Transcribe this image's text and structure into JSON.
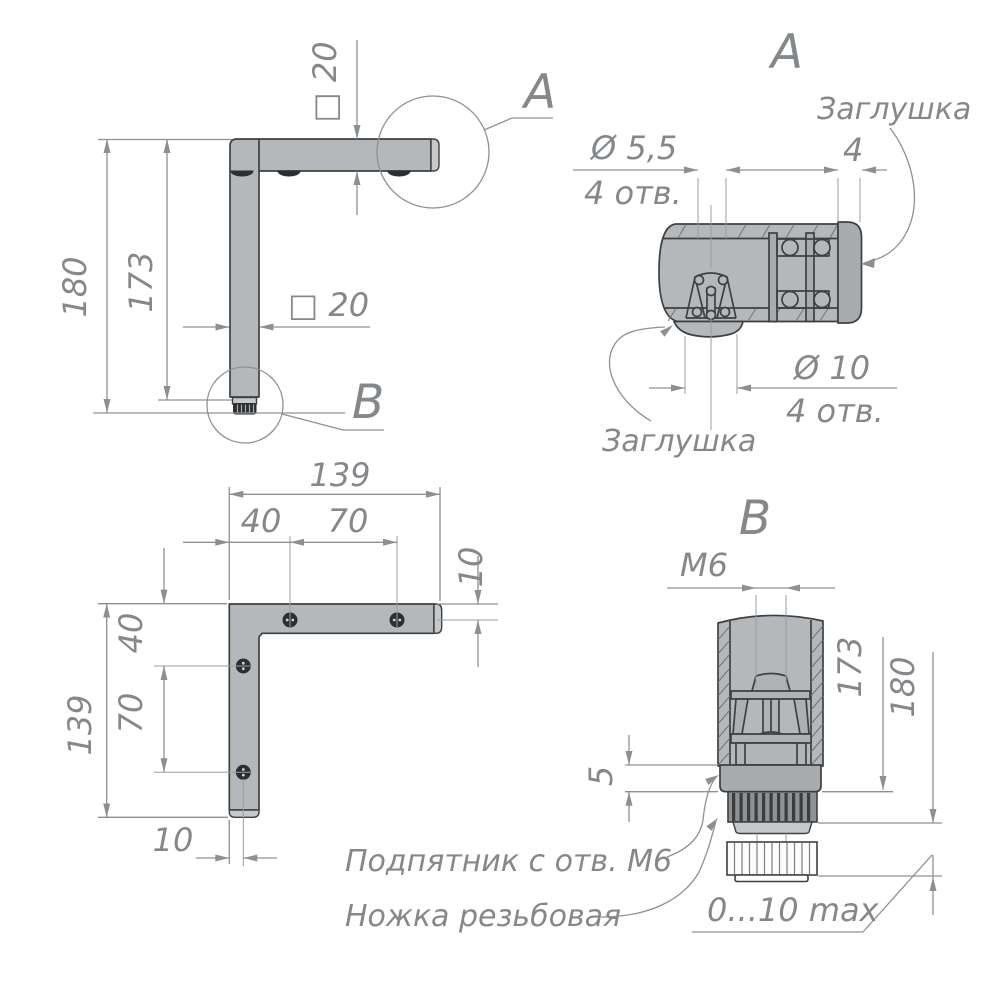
{
  "colors": {
    "paper": "#ffffff",
    "metal_fill": "#b5b8ba",
    "outline": "#3d4043",
    "dimension_gray": "#8d9093",
    "hole_black": "#2c2e30"
  },
  "main_view": {
    "dim_height_total": "180",
    "dim_height_leg": "173",
    "dim_arm_section": "□ 20",
    "dim_leg_section": "□ 20",
    "callout_a": "A",
    "callout_b": "B"
  },
  "detail_a": {
    "title": "A",
    "label_plug_top": "Заглушка",
    "label_plug_bottom": "Заглушка",
    "dim_hole_dia": "Ø 5,5",
    "dim_hole_qty": "4 отв.",
    "dim_cap": "4",
    "dim_plug_dia": "Ø 10",
    "dim_plug_qty": "4 отв."
  },
  "plan_view": {
    "dim_width": "139",
    "dim_hole_a": "40",
    "dim_hole_b": "70",
    "dim_edge_right": "10",
    "dim_height": "139",
    "dim_hole_c": "40",
    "dim_hole_d": "70",
    "dim_edge_bottom": "10"
  },
  "detail_b": {
    "title": "B",
    "dim_thread": "М6",
    "dim_leg": "173",
    "dim_total": "180",
    "dim_collar": "5",
    "dim_adjust": "0...10 max",
    "label_foot_pad": "Подпятник с отв. М6",
    "label_threaded_leg": "Ножка резьбовая"
  }
}
